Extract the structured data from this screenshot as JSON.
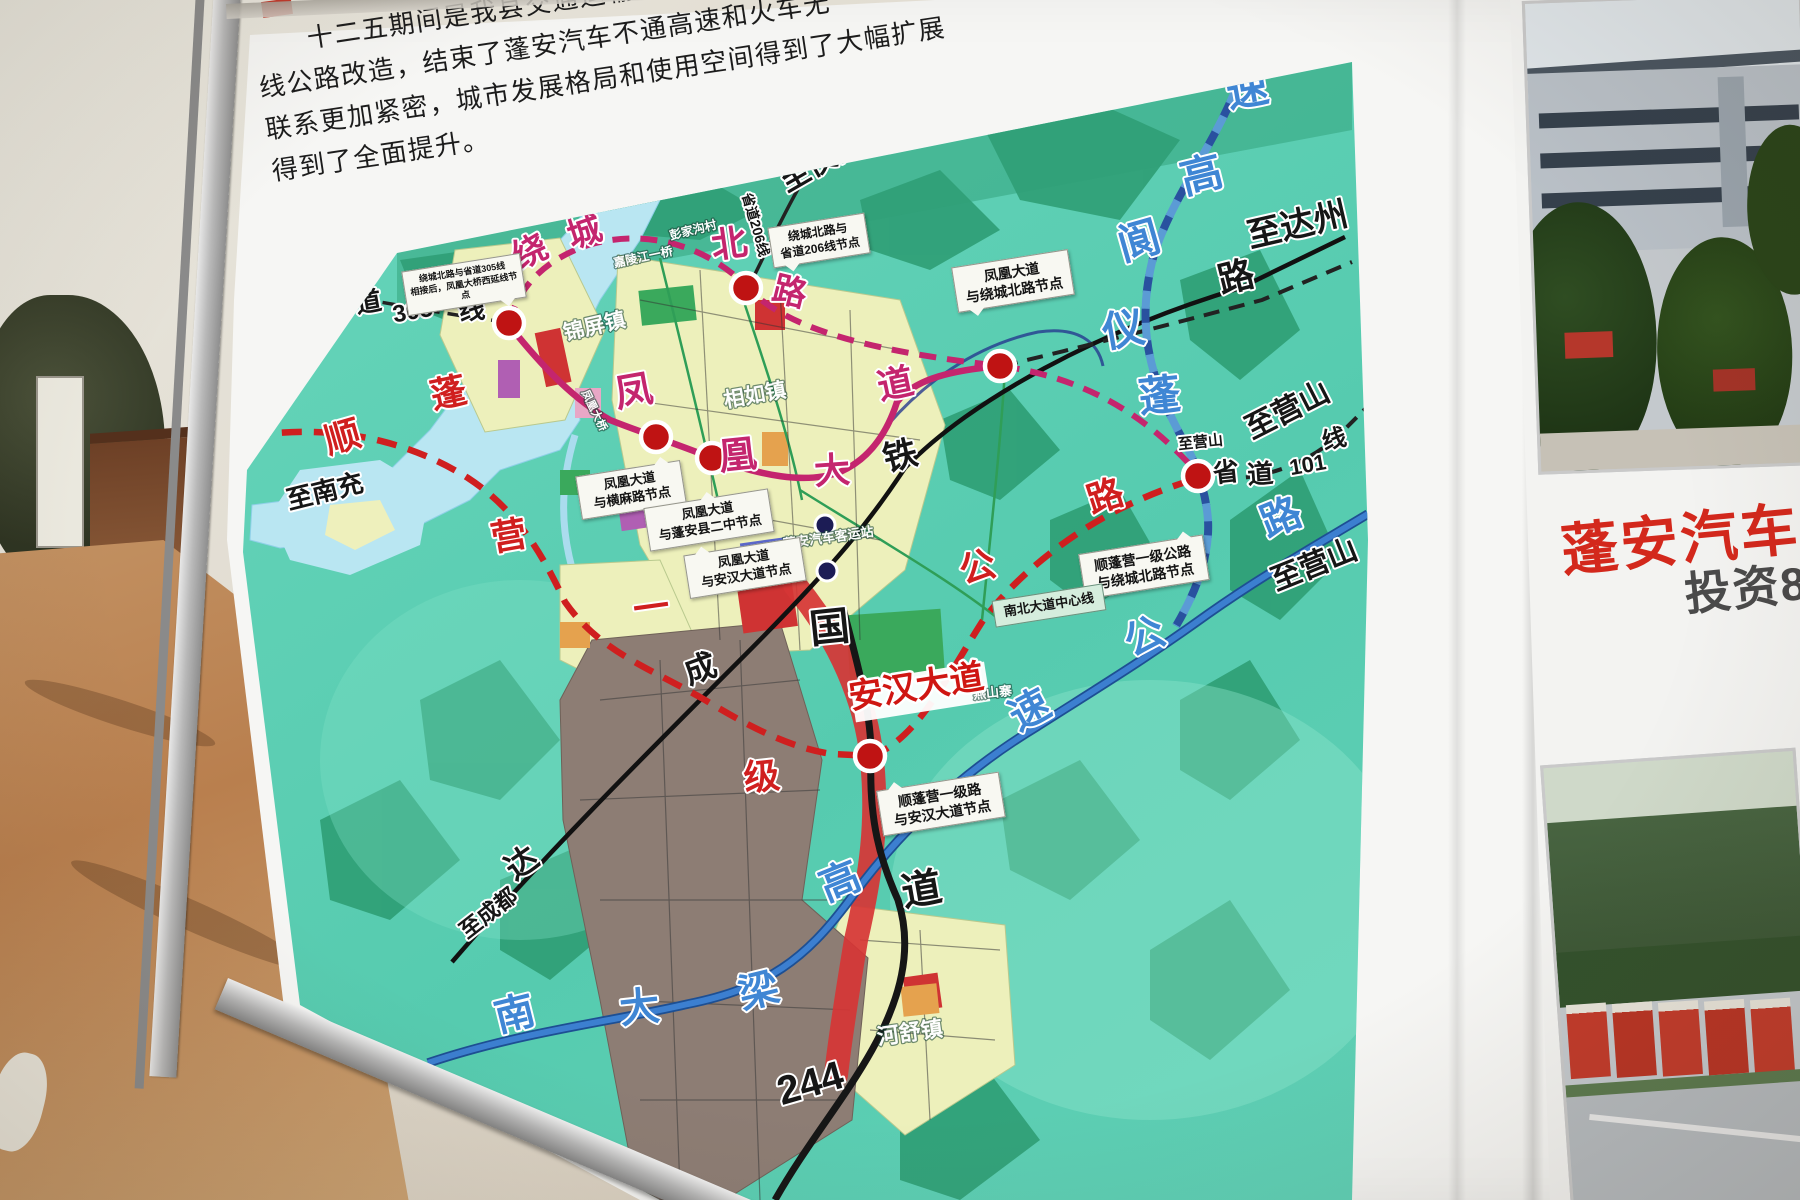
{
  "board": {
    "paragraph": [
      "十二五期间是我县交通运输事业跨越式发展",
      "线公路改造，结束了蓬安汽车不通高速和火车无",
      "联系更加紧密，城市发展格局和使用空间得到了大幅扩展",
      "得到了全面提升。"
    ]
  },
  "colors": {
    "map_teal": "#5ccfb4",
    "road_magenta": "#c4256e",
    "road_red": "#cf1f1f",
    "road_blue": "#3c7fd0",
    "headline_red": "#d3281c"
  },
  "map": {
    "labels": [
      {
        "t": "绕",
        "x": 535,
        "y": 262,
        "s": 34,
        "r": -25,
        "k": "mag"
      },
      {
        "t": "城",
        "x": 588,
        "y": 243,
        "s": 34,
        "r": -18,
        "k": "mag"
      },
      {
        "t": "北",
        "x": 731,
        "y": 256,
        "s": 36,
        "r": -8,
        "k": "mag"
      },
      {
        "t": "路",
        "x": 787,
        "y": 303,
        "s": 34,
        "r": 14,
        "k": "mag"
      },
      {
        "t": "凤",
        "x": 636,
        "y": 404,
        "s": 38,
        "r": -10,
        "k": "mag"
      },
      {
        "t": "凰",
        "x": 739,
        "y": 468,
        "s": 38,
        "r": -6,
        "k": "mag"
      },
      {
        "t": "大",
        "x": 833,
        "y": 483,
        "s": 36,
        "r": -4,
        "k": "mag"
      },
      {
        "t": "道",
        "x": 898,
        "y": 396,
        "s": 36,
        "r": -12,
        "k": "mag"
      },
      {
        "t": "道",
        "x": 370,
        "y": 311,
        "s": 26,
        "r": -10,
        "k": "blk"
      },
      {
        "t": "305",
        "x": 414,
        "y": 319,
        "s": 24,
        "r": -10,
        "k": "blk"
      },
      {
        "t": "线",
        "x": 473,
        "y": 319,
        "s": 26,
        "r": -8,
        "k": "blk"
      },
      {
        "t": "至南部",
        "x": 283,
        "y": 288,
        "s": 24,
        "r": -28,
        "k": "blk"
      },
      {
        "t": "至南充",
        "x": 327,
        "y": 500,
        "s": 26,
        "r": -14,
        "k": "blk"
      },
      {
        "t": "至仪陇",
        "x": 826,
        "y": 170,
        "s": 30,
        "r": -30,
        "k": "blk"
      },
      {
        "t": "省道206线",
        "x": 751,
        "y": 226,
        "s": 14,
        "r": 74,
        "k": "blk"
      },
      {
        "t": "至达州",
        "x": 1300,
        "y": 236,
        "s": 34,
        "r": -13,
        "k": "blk"
      },
      {
        "t": "路",
        "x": 1239,
        "y": 289,
        "s": 36,
        "r": -14,
        "k": "blk"
      },
      {
        "t": "达",
        "x": 528,
        "y": 872,
        "s": 32,
        "r": -35,
        "k": "blk"
      },
      {
        "t": "成",
        "x": 704,
        "y": 679,
        "s": 32,
        "r": -20,
        "k": "blk"
      },
      {
        "t": "铁",
        "x": 903,
        "y": 467,
        "s": 34,
        "r": -14,
        "k": "blk"
      },
      {
        "t": "国",
        "x": 831,
        "y": 641,
        "s": 40,
        "r": -6,
        "k": "blk"
      },
      {
        "t": "道",
        "x": 924,
        "y": 903,
        "s": 40,
        "r": -10,
        "k": "blk"
      },
      {
        "t": "244",
        "x": 814,
        "y": 1096,
        "s": 40,
        "r": -16,
        "k": "blk"
      },
      {
        "t": "至成都",
        "x": 493,
        "y": 919,
        "s": 22,
        "r": -38,
        "k": "blk"
      },
      {
        "t": "至营山",
        "x": 1201,
        "y": 447,
        "s": 15,
        "r": -6,
        "k": "blk"
      },
      {
        "t": "省",
        "x": 1227,
        "y": 481,
        "s": 26,
        "r": -6,
        "k": "blk"
      },
      {
        "t": "道",
        "x": 1261,
        "y": 483,
        "s": 26,
        "r": -4,
        "k": "blk"
      },
      {
        "t": "101",
        "x": 1309,
        "y": 472,
        "s": 22,
        "r": -10,
        "k": "blk"
      },
      {
        "t": "线",
        "x": 1336,
        "y": 447,
        "s": 24,
        "r": -14,
        "k": "blk"
      },
      {
        "t": "至营山",
        "x": 1292,
        "y": 419,
        "s": 30,
        "r": -27,
        "k": "blk"
      },
      {
        "t": "至营山",
        "x": 1318,
        "y": 574,
        "s": 30,
        "r": -22,
        "k": "blk"
      },
      {
        "t": "速",
        "x": 1250,
        "y": 104,
        "s": 42,
        "r": -10,
        "k": "blue"
      },
      {
        "t": "高",
        "x": 1205,
        "y": 189,
        "s": 42,
        "r": -14,
        "k": "blue"
      },
      {
        "t": "阆",
        "x": 1143,
        "y": 255,
        "s": 42,
        "r": -16,
        "k": "blue"
      },
      {
        "t": "仪",
        "x": 1126,
        "y": 344,
        "s": 42,
        "r": -10,
        "k": "blue"
      },
      {
        "t": "蓬",
        "x": 1161,
        "y": 410,
        "s": 42,
        "r": -6,
        "k": "blue"
      },
      {
        "t": "南",
        "x": 518,
        "y": 1027,
        "s": 40,
        "r": -14,
        "k": "blue"
      },
      {
        "t": "大",
        "x": 641,
        "y": 1021,
        "s": 40,
        "r": -6,
        "k": "blue"
      },
      {
        "t": "梁",
        "x": 762,
        "y": 1004,
        "s": 40,
        "r": -14,
        "k": "blue"
      },
      {
        "t": "高",
        "x": 845,
        "y": 894,
        "s": 40,
        "r": -22,
        "k": "blue"
      },
      {
        "t": "速",
        "x": 1036,
        "y": 722,
        "s": 40,
        "r": -28,
        "k": "blue"
      },
      {
        "t": "公",
        "x": 1150,
        "y": 649,
        "s": 40,
        "r": -24,
        "k": "blue"
      },
      {
        "t": "路",
        "x": 1286,
        "y": 530,
        "s": 40,
        "r": -22,
        "k": "blue"
      },
      {
        "t": "顺",
        "x": 346,
        "y": 449,
        "s": 36,
        "r": -16,
        "k": "red"
      },
      {
        "t": "蓬",
        "x": 451,
        "y": 405,
        "s": 36,
        "r": -12,
        "k": "red"
      },
      {
        "t": "营",
        "x": 511,
        "y": 548,
        "s": 36,
        "r": -10,
        "k": "red"
      },
      {
        "t": "一",
        "x": 653,
        "y": 620,
        "s": 36,
        "r": -8,
        "k": "red"
      },
      {
        "t": "级",
        "x": 763,
        "y": 789,
        "s": 36,
        "r": -6,
        "k": "red"
      },
      {
        "t": "公",
        "x": 981,
        "y": 579,
        "s": 36,
        "r": -16,
        "k": "red"
      },
      {
        "t": "路",
        "x": 1109,
        "y": 508,
        "s": 36,
        "r": -18,
        "k": "red"
      },
      {
        "t": "锦屏镇",
        "x": 596,
        "y": 333,
        "s": 21,
        "r": -13,
        "k": "wht"
      },
      {
        "t": "相如镇",
        "x": 756,
        "y": 402,
        "s": 21,
        "r": -10,
        "k": "wht"
      },
      {
        "t": "河舒镇",
        "x": 911,
        "y": 1040,
        "s": 22,
        "r": -8,
        "k": "wht"
      },
      {
        "t": "彭家沟村",
        "x": 694,
        "y": 234,
        "s": 12,
        "r": -14,
        "k": "wht"
      },
      {
        "t": "嘉陵江一桥",
        "x": 644,
        "y": 261,
        "s": 12,
        "r": -12,
        "k": "wht"
      },
      {
        "t": "凤凰大桥",
        "x": 591,
        "y": 412,
        "s": 11,
        "r": 64,
        "k": "wht"
      },
      {
        "t": "蓬安汽车客运站",
        "x": 829,
        "y": 542,
        "s": 13,
        "r": -8,
        "k": "wht"
      },
      {
        "t": "燕山寨",
        "x": 993,
        "y": 697,
        "s": 13,
        "r": -6,
        "k": "wht"
      },
      {
        "t": "安汉大道",
        "x": 918,
        "y": 698,
        "s": 34,
        "r": -9,
        "k": "redband"
      }
    ],
    "callouts": [
      {
        "lines": [
          "绕城北路与省道305线",
          "相接后，凤凰大桥西延线节点"
        ],
        "x": 404,
        "y": 262,
        "w": 108,
        "fs": 9,
        "tail": "br"
      },
      {
        "lines": [
          "绕城北路与",
          "省道206线节点"
        ],
        "x": 770,
        "y": 220,
        "w": 86,
        "fs": 12,
        "tail": "bl"
      },
      {
        "lines": [
          "凤凰大道",
          "与绕城北路节点"
        ],
        "x": 954,
        "y": 258,
        "w": 106,
        "fs": 14,
        "tail": "bl"
      },
      {
        "lines": [
          "凤凰大道",
          "与横麻路节点"
        ],
        "x": 578,
        "y": 468,
        "w": 94,
        "fs": 13,
        "tail": "tr"
      },
      {
        "lines": [
          "凤凰大道",
          "与蓬安县二中节点"
        ],
        "x": 646,
        "y": 498,
        "w": 114,
        "fs": 13,
        "tail": "t"
      },
      {
        "lines": [
          "凤凰大道",
          "与安汉大道节点"
        ],
        "x": 686,
        "y": 546,
        "w": 106,
        "fs": 13,
        "tail": "tl"
      },
      {
        "lines": [
          "顺蓬营一级公路",
          "与绕城北路节点"
        ],
        "x": 1081,
        "y": 544,
        "w": 114,
        "fs": 14,
        "tail": "tr"
      },
      {
        "lines": [
          "顺蓬营一级路",
          "与安汉大道节点"
        ],
        "x": 879,
        "y": 781,
        "w": 112,
        "fs": 14,
        "tail": "tl"
      },
      {
        "lines": [
          "南北大道中心线"
        ],
        "x": 993,
        "y": 592,
        "w": 100,
        "fs": 13,
        "tail": "",
        "variant": "tag"
      }
    ],
    "nodes": [
      [
        509,
        323
      ],
      [
        656,
        437
      ],
      [
        712,
        458
      ],
      [
        746,
        288
      ],
      [
        1000,
        366
      ],
      [
        1198,
        476
      ],
      [
        870,
        756
      ]
    ],
    "stations": [
      [
        825,
        525
      ],
      [
        827,
        571
      ]
    ]
  },
  "side_panel": {
    "headline": "蓬安汽车客运",
    "line2": "投资8"
  }
}
